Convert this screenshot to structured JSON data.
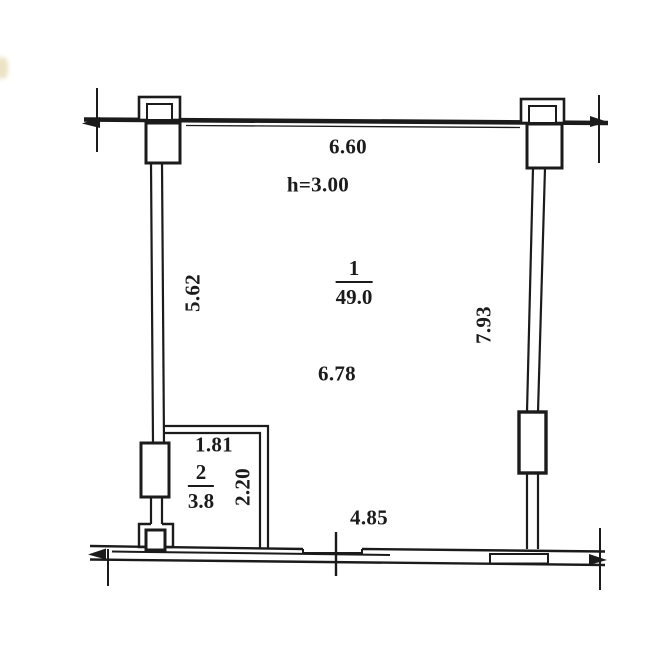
{
  "document": {
    "type": "apartment floor plan (scanned technical drawing)",
    "colors": {
      "ink": "#1b1b1b",
      "paper": "#ffffff"
    }
  },
  "rooms": [
    {
      "number": "1",
      "area": "49.0"
    },
    {
      "number": "2",
      "area": "3.8"
    }
  ],
  "dimensions": {
    "top_width": "6.60",
    "ceiling_height": "h=3.00",
    "left_wall_length": "5.62",
    "right_wall_length": "7.93",
    "room1_inner_width": "6.78",
    "room2_inner_width": "1.81",
    "room2_inner_depth": "2.20",
    "bottom_inner_width": "4.85"
  }
}
